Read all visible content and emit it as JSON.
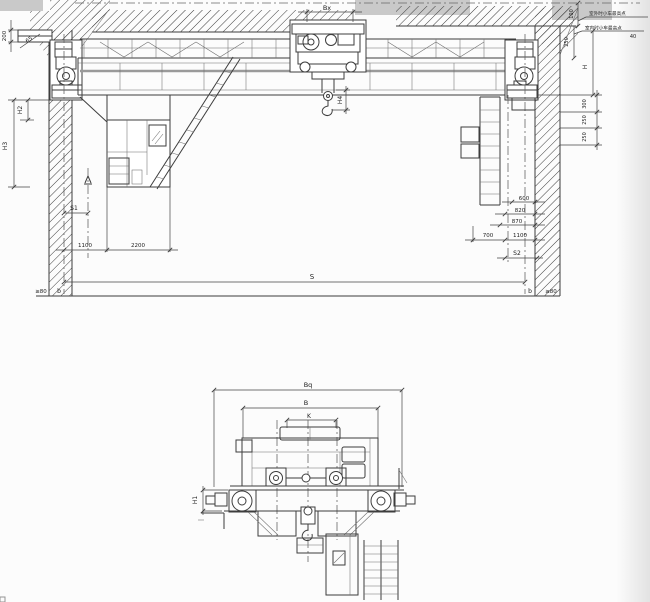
{
  "colors": {
    "line": "#3d3d3d",
    "rail_highlight": "#9a9a9a",
    "shade_band": "#c9c9c9",
    "paper": "#fcfcfc"
  },
  "main_view": {
    "dims": {
      "ceiling_200": "200",
      "corbel_65": "65",
      "trolley_bx": "Bx",
      "hook_h4": "H4",
      "left_h2": "H2",
      "left_h3": "H3",
      "left_s1": "S1",
      "left_1100": "1100",
      "left_2200": "2200",
      "span_s": "S",
      "floor_left_min": "≥80",
      "floor_left_b": "b",
      "floor_right_b": "b",
      "floor_right_min": "≥80",
      "roof_100": "100",
      "roof_250": "250",
      "crane_h": "H",
      "right_300": "300",
      "right_250_a": "250",
      "right_250_b": "250",
      "right_600": "600",
      "right_820": "820",
      "right_870": "870",
      "right_700": "700",
      "right_1100": "1100",
      "right_s2": "S2",
      "clearance_40": "40"
    },
    "notes": {
      "outdoor_max": "室外时小车最高点",
      "indoor_max": "室内时小车最高点"
    }
  },
  "end_view": {
    "dims": {
      "overall_bq": "Bq",
      "width_b": "B",
      "gauge_k": "K",
      "height_h1": "H1"
    }
  }
}
